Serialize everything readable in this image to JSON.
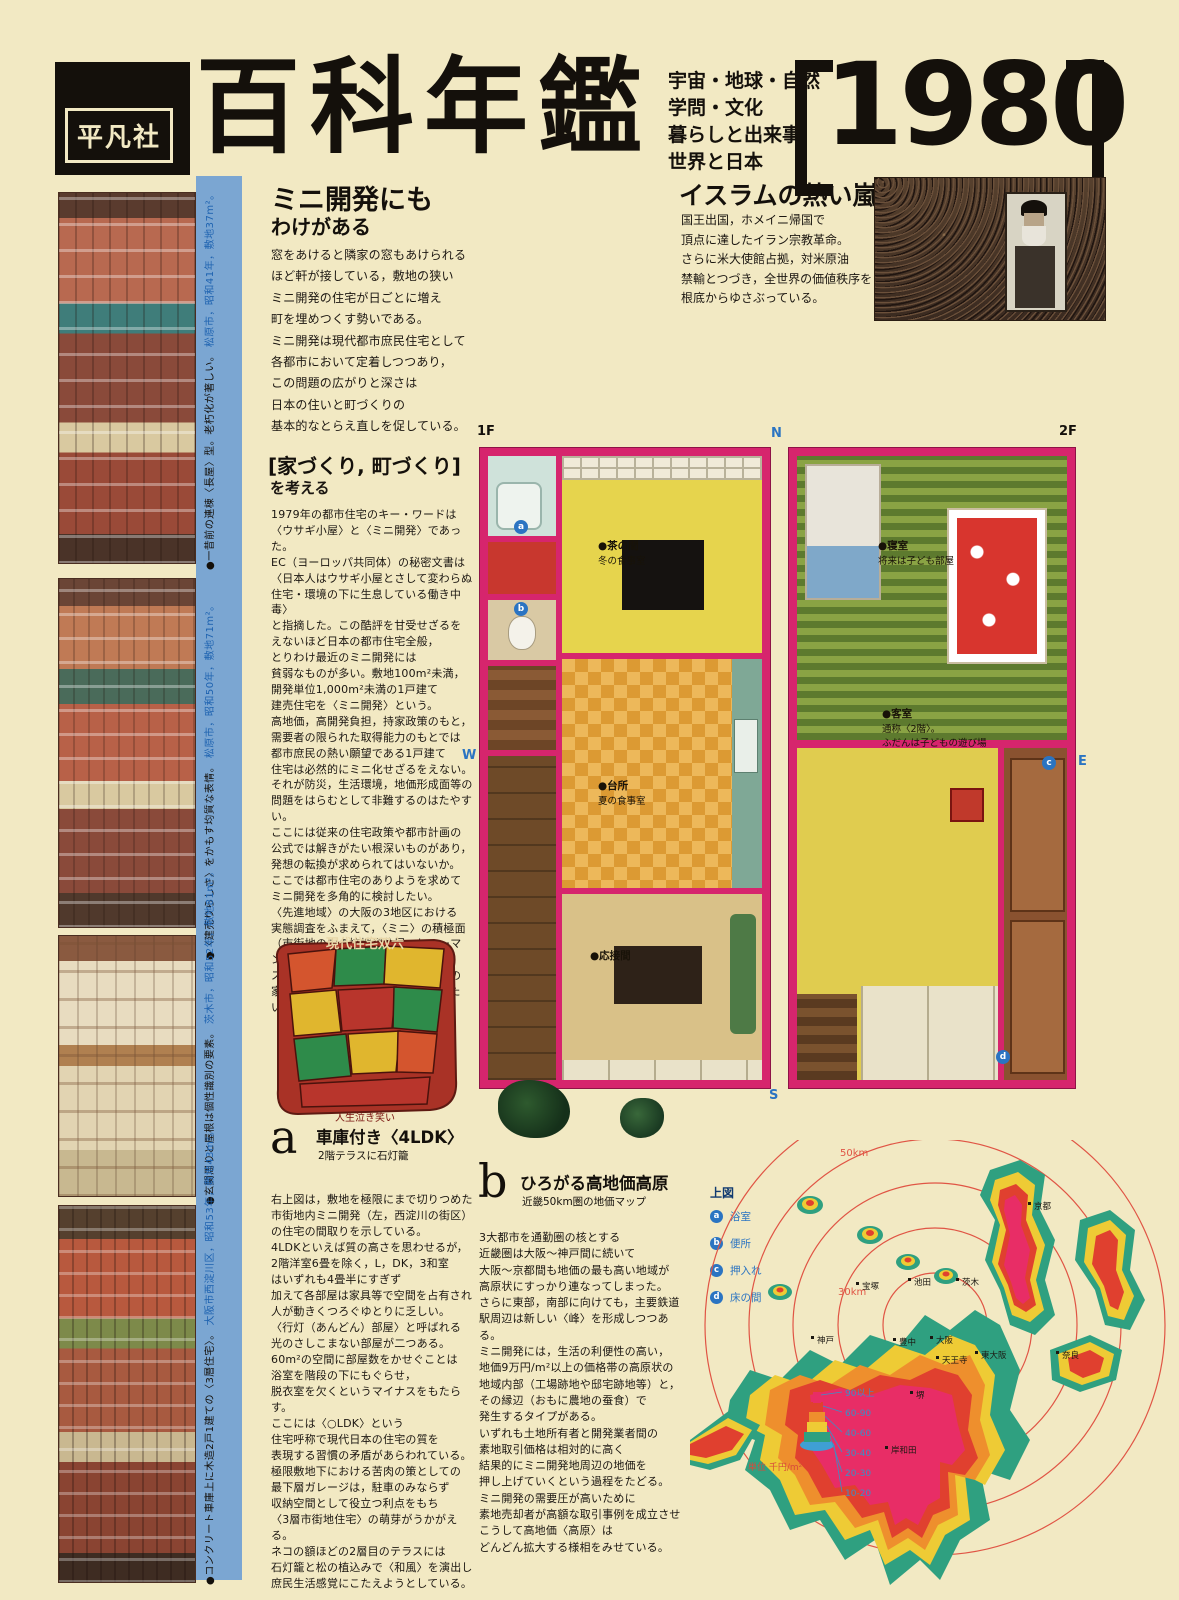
{
  "colors": {
    "paper": "#f2e9c3",
    "blue_strip": "#7ba6d2",
    "plan_wall": "#d6256d",
    "accent_blue": "#2b74c2",
    "ring_red": "#e05545",
    "legend_text_blue": "#3a8fc7"
  },
  "header": {
    "publisher": "平凡社",
    "title": "百科年鑑",
    "subtitle_lines": [
      "宇宙・地球・自然",
      "学問・文化",
      "暮らしと出来事",
      "世界と日本"
    ],
    "year": "1980"
  },
  "mini": {
    "title_em": "ミニ",
    "title_rest": "開発にも",
    "title2_em": "わけ",
    "title2_rest": "がある",
    "body": "窓をあけると隣家の窓もあけられる\nほど軒が接している，敷地の狭い\nミニ開発の住宅が日ごとに増え\n町を埋めつくす勢いである。\nミニ開発は現代都市庶民住宅として\n各都市において定着しつつあり，\nこの問題の広がりと深さは\n日本の住いと町づくりの\n基本的なとらえ直しを促している。"
  },
  "islam": {
    "title": "イスラムの熱い嵐",
    "body": "国王出国，ホメイニ帰国で\n頂点に達したイラン宗教革命。\nさらに米大使館占拠，対米原油\n禁輸とつづき，全世界の価値秩序を\n根底からゆさぶっている。",
    "photo": "khomeini-crowd-photo"
  },
  "machizukuri": {
    "title": "[家づくり, 町づくり]",
    "subtitle": "を考える",
    "body": "1979年の都市住宅のキー・ワードは\n〈ウサギ小屋〉と〈ミニ開発〉であった。\nEC（ヨーロッパ共同体）の秘密文書は\n〈日本人はウサギ小屋とさして変わらぬ\n住宅・環境の下に生息している働き中毒〉\nと指摘した。この酷評を甘受せざるを\nえないほど日本の都市住宅全般，\nとりわけ最近のミニ開発には\n貧弱なものが多い。敷地100m²未満，\n開発単位1,000m²未満の1戸建て\n建売住宅を〈ミニ開発〉という。\n高地価，高開発負担，持家政策のもと，\n需要者の限られた取得能力のもとでは\n都市庶民の熱い願望である1戸建て\n住宅は必然的にミニ化せざるをえない。\nそれが防災，生活環境，地価形成面等の\n問題をはらむとして非難するのはたやすい。\nここには従来の住宅政策や都市計画の\n公式では解きがたい根深いものがあり，\n発想の転換が求められてはいないか。\nここでは都市住宅のありようを求めて\nミニ開発を多角的に検討したい。\n〈先進地域〉の大阪の3地区における\n実態調査をふまえて，〈ミニ〉の積極面\n（市街地の中の接地型住居，ヒューマン・\nスケールの開発）を生かした，今後の\n家づくり，町づくりの方向を展望したい。"
  },
  "sugoroku": {
    "title": "現代住宅双六",
    "caption": "人生泣き笑い"
  },
  "section_a": {
    "marker": "a",
    "title": "車庫付き〈4LDK〉",
    "subtitle": "2階テラスに石灯籠",
    "body": "右上図は，敷地を極限にまで切りつめた\n市街地内ミニ開発（左，西淀川の街区）\nの住宅の間取りを示している。\n4LDKといえば質の高さを思わせるが，\n2階洋室6畳を除く，L，DK，3和室\nはいずれも4畳半にすぎず\n加えて各部屋は家具等で空間を占有され\n人が動きくつろぐゆとりに乏しい。\n〈行灯（あんどん）部屋〉と呼ばれる\n光のさしこまない部屋が二つある。\n60m²の空間に部屋数をかせぐことは\n浴室を階段の下にもぐらせ，\n脱衣室を欠くというマイナスをもたらす。\nここには〈○LDK〉という\n住宅呼称で現代日本の住宅の質を\n表現する習慣の矛盾があらわれている。\n極限敷地下における苦肉の策としての\n最下層ガレージは，駐車のみならず\n収納空間として役立つ利点をもち\n〈3層市街地住宅〉の萌芽がうかがえる。\nネコの額ほどの2層目のテラスには\n石灯籠と松の植込みで〈和風〉を演出し\n庶民生活感覚にこたえようとしている。"
  },
  "section_b": {
    "marker": "b",
    "title": "ひろがる高地価高原",
    "subtitle": "近畿50km圏の地価マップ",
    "body": "3大都市を通勤圏の核とする\n近畿圏は大阪〜神戸間に続いて\n大阪〜京都間も地価の最も高い地域が\n高原状にすっかり連なってしまった。\nさらに東部，南部に向けても，主要鉄道\n駅周辺は新しい〈峰〉を形成しつつある。\nミニ開発には，生活の利便性の高い，\n地価9万円/m²以上の価格帯の高原状の\n地域内部（工場跡地や邸宅跡地等）と，\nその縁辺（おもに農地の蚕食）で\n発生するタイプがある。\nいずれも土地所有者と開発業者間の\n素地取引価格は相対的に高く\n結果的にミニ開発地周辺の地価を\n押し上げていくという過程をたどる。\nミニ開発の需要圧が高いために\n素地売却者が高額な取引事例を成立させ\nこうして高地価〈高原〉は\nどんどん拡大する様相をみせている。"
  },
  "left_strip": {
    "captions": [
      {
        "text": "●一昔前の連棟〈長屋〉型。老朽化が著しい。",
        "meta": "松原市，昭和41年，敷地37m²。"
      },
      {
        "text": "●〈建売りらしさ〉をかもす均質な表情。",
        "meta": "松原市，昭和50年，敷地71m²。"
      },
      {
        "text": "●玄関周りと屋根は個性識別の要素。",
        "meta": "茨木市，昭和52年，敷地81m²。"
      },
      {
        "text": "●コンクリート車庫上に木造2戸1建ての〈3層住宅〉。",
        "meta": "大阪市西淀川区，昭和53年，敷地43m²。"
      }
    ]
  },
  "floorplans": {
    "label_1f": "1F",
    "label_2f": "2F",
    "compass_n": "N",
    "compass_e": "E",
    "compass_s": "S",
    "compass_w": "W",
    "rooms_1f": [
      {
        "name": "●茶の間",
        "desc": "冬の食事室"
      },
      {
        "name": "●台所",
        "desc": "夏の食事室"
      },
      {
        "name": "●応接間",
        "desc": ""
      }
    ],
    "rooms_2f": [
      {
        "name": "●寝室",
        "desc": "将来は子ども部屋"
      },
      {
        "name": "●客室",
        "desc": "通称〈2階〉。\nふだんは子どもの遊び場"
      }
    ]
  },
  "plan_legend": {
    "title": "上図",
    "items": [
      {
        "key": "a",
        "label": "浴室"
      },
      {
        "key": "b",
        "label": "便所"
      },
      {
        "key": "c",
        "label": "押入れ"
      },
      {
        "key": "d",
        "label": "床の間"
      }
    ]
  },
  "price_map": {
    "ring_labels": [
      "50km",
      "30km"
    ],
    "unit": "単位 千円/m²",
    "legend": [
      "90以上",
      "60-90",
      "40-60",
      "30-40",
      "20-30",
      "10-20"
    ],
    "cities": [
      "京都",
      "宝塚",
      "池田",
      "茨木",
      "神戸",
      "豊中",
      "大阪",
      "東大阪",
      "天王寺",
      "奈良",
      "堺",
      "岸和田"
    ]
  }
}
